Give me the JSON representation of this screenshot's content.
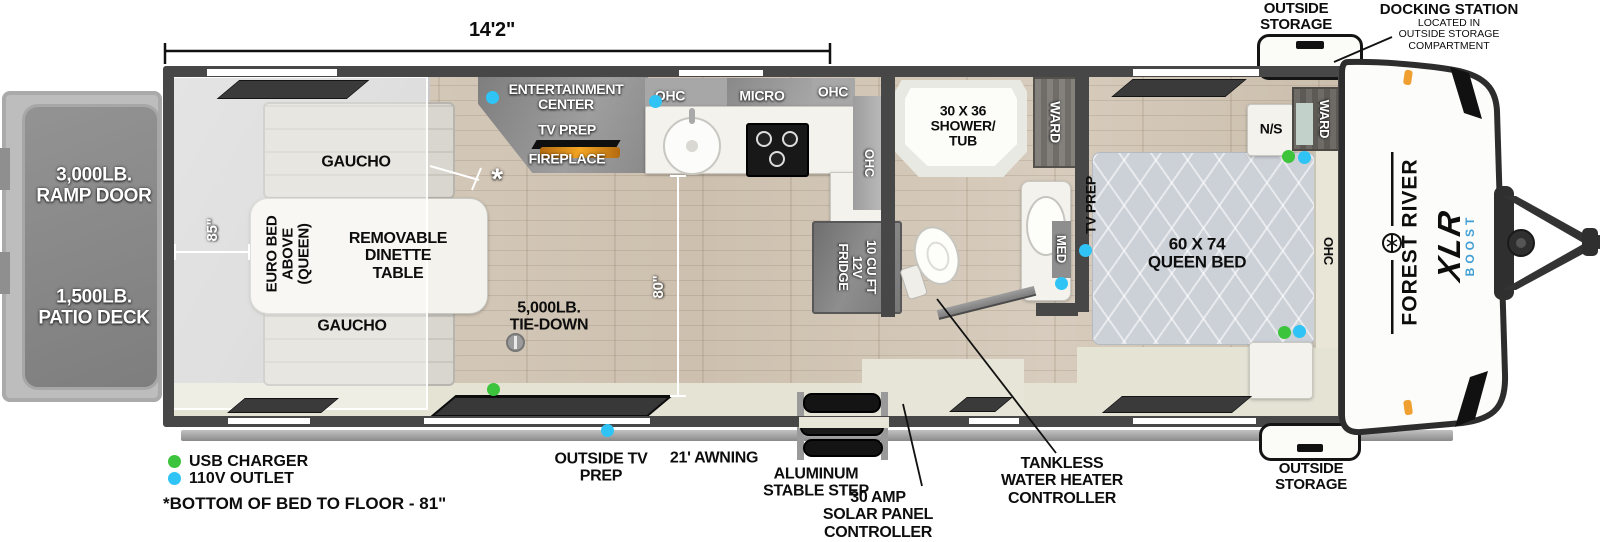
{
  "title": "Toy hauler travel trailer floorplan",
  "colors": {
    "usb_dot": "#3cc43c",
    "outlet_dot": "#2fc4f5",
    "marker_light": "#f0a030",
    "boost_blue": "#3f9fd4"
  },
  "dimensions": {
    "overall": "14'2\"",
    "garage_width": "85\"",
    "kitchen_depth": "80\""
  },
  "exterior": {
    "ramp_door": "3,000LB.\nRAMP DOOR",
    "patio_deck": "1,500LB.\nPATIO DECK",
    "outside_storage": "OUTSIDE\nSTORAGE",
    "docking_station_title": "DOCKING STATION",
    "docking_station_sub": "LOCATED IN\nOUTSIDE STORAGE\nCOMPARTMENT",
    "outside_tv_prep": "OUTSIDE TV\nPREP",
    "awning": "21' AWNING",
    "step": "ALUMINUM\nSTABLE STEP",
    "solar": "30 AMP\nSOLAR PANEL\nCONTROLLER",
    "tankless": "TANKLESS\nWATER HEATER\nCONTROLLER"
  },
  "brand": {
    "maker": "FOREST RIVER",
    "model": "XLR",
    "series": "BOOST"
  },
  "garage": {
    "gaucho": "GAUCHO",
    "euro_bed": "EURO BED\nABOVE\n(QUEEN)",
    "dinette": "REMOVABLE\nDINETTE\nTABLE",
    "tie_down": "5,000LB.\nTIE-DOWN",
    "asterisk": "*"
  },
  "kitchen": {
    "entertainment": "ENTERTAINMENT\nCENTER",
    "tv_prep": "TV PREP",
    "fireplace": "FIREPLACE",
    "ohc": "OHC",
    "micro": "MICRO",
    "fridge": "10 CU FT\n12V\nFRIDGE"
  },
  "bath": {
    "shower": "30 X 36\nSHOWER/\nTUB",
    "ward": "WARD",
    "med": "MED"
  },
  "bedroom": {
    "tv_prep": "TV PREP",
    "bed": "60 X 74\nQUEEN BED",
    "nightstand": "N/S",
    "ward": "WARD",
    "ohc": "OHC"
  },
  "legend": {
    "usb": "USB CHARGER",
    "outlet": "110V OUTLET",
    "footnote": "*BOTTOM OF BED TO FLOOR - 81\""
  }
}
